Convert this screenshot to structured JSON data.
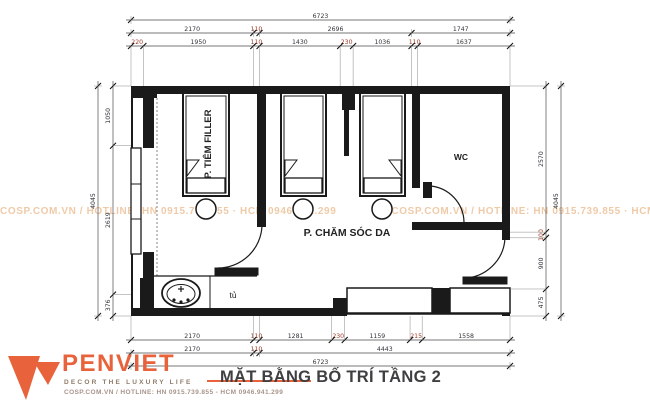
{
  "title": "MẶT BẰNG BỐ TRÍ TẦNG 2",
  "brand": {
    "name": "PENVIET",
    "tagline": "DECOR THE LUXURY LIFE",
    "hotline": "COSP.COM.VN / HOTLINE: HN 0915.739.855 - HCM 0946.941.299",
    "accent": "#E8633B"
  },
  "watermark": {
    "text": "COSP.COM.VN / HOTLINE: HN 0915.739.855 · HCM 0946.941.299"
  },
  "rooms": {
    "room1": "P. TIÊM FILLER",
    "room2": "P. CHĂM SÓC DA",
    "wc": "WC",
    "cabinet": "tủ"
  },
  "dimensions": {
    "top": {
      "rows": [
        [
          6723
        ],
        [
          2170,
          110,
          2696,
          1747
        ],
        [
          220,
          1950,
          110,
          1430,
          230,
          1036,
          110,
          1637
        ]
      ]
    },
    "bottom": {
      "rows": [
        [
          2170,
          110,
          1281,
          230,
          1159,
          215,
          1558
        ],
        [
          2170,
          110,
          4443
        ],
        [
          6723
        ]
      ]
    },
    "left": {
      "rows": [
        [
          4045
        ],
        [
          1050,
          2619,
          376
        ]
      ]
    },
    "right": {
      "rows": [
        [
          2570,
          100,
          900,
          475
        ],
        [
          4045
        ]
      ]
    },
    "text_color": "#33333b",
    "small_color": "#9c3a28"
  }
}
